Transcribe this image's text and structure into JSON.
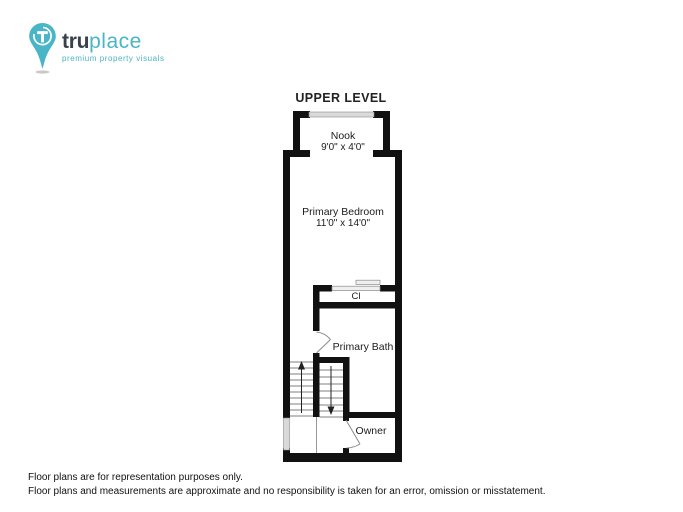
{
  "logo": {
    "brand_bold": "tru",
    "brand_light": "place",
    "tagline": "premium property visuals"
  },
  "title": "UPPER LEVEL",
  "rooms": [
    {
      "name": "Nook",
      "dims": "9'0\" x 4'0\""
    },
    {
      "name": "Primary Bedroom",
      "dims": "11'0\" x 14'0\""
    },
    {
      "name": "Cl"
    },
    {
      "name": "Primary Bath"
    },
    {
      "name": "Owner"
    }
  ],
  "footer": {
    "line1": "Floor plans are for representation purposes only.",
    "line2": "Floor plans and measurements are approximate and no responsibility is taken for an error, omission or misstatement."
  },
  "colors": {
    "accent": "#4ab5c7",
    "brand_dark": "#39424c",
    "wall": "#111111",
    "window": "#d9d9d9",
    "text": "#1a1a1a"
  }
}
